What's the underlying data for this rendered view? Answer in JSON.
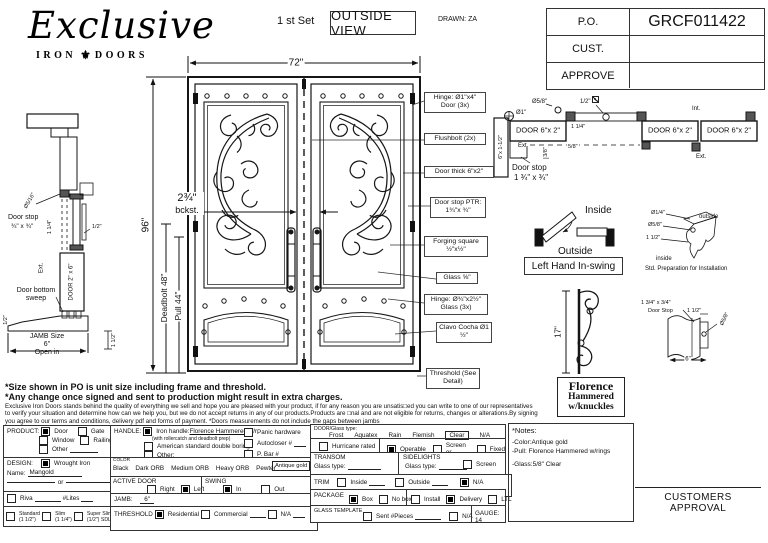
{
  "logo": {
    "script": "Exclusive",
    "left": "IRON",
    "mark": "⚜",
    "right": "DOORS"
  },
  "header": {
    "set": "1 st Set",
    "view": "OUTSIDE VIEW",
    "drawn": "DRAWN: ZA"
  },
  "po": {
    "r1l": "P.O.",
    "r1v": "GRCF011422",
    "r2l": "CUST.",
    "r2v": "",
    "r3l": "APPROVE",
    "r3v": ""
  },
  "door": {
    "w": "72\"",
    "h": "96\"",
    "deadbolt": "Deadbolt 48\"",
    "pull": "Pull 44\"",
    "backset1": "2¾\"",
    "backset2": "bckst."
  },
  "callouts": {
    "hinge_door": "Hinge: Ø1\"x4\" Door (3x)",
    "flushbolt": "Flushbolt (2x)",
    "door_thick": "Door thick 6\"x2\"",
    "door_stop": "Door stop PTR: 1¾\"x ¾\"",
    "forging": "Forging square ½\"x½\"",
    "glass": "Glass ⅝\"",
    "hinge_glass": "Hinge: Ø¾\"x2½\" Glass (3x)",
    "clavo": "Clavo Cocha Ø1 ½\"",
    "threshold": "Threshold (See Detail)"
  },
  "left_detail": {
    "dia": "Ø5/16\"",
    "stop1": "Door stop",
    "stop2": "¾\" x ¾\"",
    "dim114": "1 1/4\"",
    "dim12": "1/2\"",
    "ext": "Ext.",
    "door": "DOOR 2\" x 6\"",
    "sweep": "Door bottom sweep",
    "jamb1": "JAMB Size",
    "jamb2": "6\"",
    "open": "Open in",
    "dim112": "1 1/2\"",
    "dim12b": "1/2\""
  },
  "top_detail": {
    "dia1": "Ø1\"",
    "dia58": "Ø5/8\"",
    "dim12": "1/2\"",
    "jamb": "6\"x 1-1/2\"",
    "door1": "DOOR 6\"x 2\"",
    "door2": "DOOR 6\"x 2\"",
    "door3": "DOOR 6\"x 2\"",
    "ext1": "Ext.",
    "dim38": "3/8\"",
    "dim114": "1 1/4\"",
    "dim58": "5/8\"",
    "stop1": "Door stop",
    "stop2": "1 ¾\" x ¾\"",
    "int1": "Int.",
    "ext2": "Ext."
  },
  "swing": {
    "inside": "Inside",
    "outside": "Outside",
    "label": "Left Hand In-swing"
  },
  "prep": {
    "d14": "Ø1/4\"",
    "d58": "Ø5/8\"",
    "d112": "1 1/2\"",
    "outside": "outside",
    "inside": "inside",
    "caption": "Std. Preparation for Installation"
  },
  "pull_detail": {
    "dim": "17\"",
    "name1": "Florence",
    "name2": "Hammered",
    "name3": "w/knuckles"
  },
  "profile": {
    "stop1": "1 3/4\" x 3/4\"",
    "stop2": "Door Stop",
    "d112": "1 1/2\"",
    "d58": "Ø5/8\"",
    "d6": "6\""
  },
  "disclaimer": {
    "b1": "*Size shown in PO is unit size including frame and threshold.",
    "b2": "*Any change once signed and sent to production might result in extra charges.",
    "p": "Exclusive Iron Doors stands behind the quality of everything we sell and hope you are pleased with your product, if for any reason you are unsatis□ed you can write to one of our representatives to verify your situation and determine how can we help you, but we do not accept returns in any of our products.Products are □nal and are not eligible for returns, changes or alterations.By signing you agree to our terms and conditions, delivery pdf and forms of payment. *Doors measurements do not include the gaps between jambs"
  },
  "form": {
    "product": {
      "title": "PRODUCT:",
      "door": "Door",
      "door_on": true,
      "gate": "Gate",
      "gate_on": false,
      "window": "Window",
      "window_on": false,
      "railing": "Railing",
      "railing_on": false,
      "other": "Other",
      "other_on": false
    },
    "design": {
      "title": "DESIGN:",
      "wrought": "Wrought Iron",
      "wrought_on": true,
      "name_label": "Name:",
      "name_value": "Mangold",
      "or_label": "or",
      "riva": "Riva",
      "riva_on": false,
      "lites": "#Lites"
    },
    "thickness": {
      "standard": "Standard",
      "standard_sub": "(1 1/2\")",
      "standard_on": false,
      "slim": "Slim",
      "slim_sub": "(1 1/4\")",
      "slim_on": false,
      "super": "Super Slim",
      "super_sub": "(1/2\") SDL",
      "super_on": false
    },
    "handle": {
      "title": "HANDLE:",
      "iron_pre": "Iron handle:",
      "iron_name": "Florence Hammered",
      "iron_post": "w/r",
      "iron_on": true,
      "iron_sub": "(with rollercatch and deadbolt prep)",
      "american": "American standard double boring",
      "american_on": false,
      "other": "Other:",
      "other_on": false,
      "panic": "Panic hardware",
      "panic_on": false,
      "autocloser": "Autocloser #",
      "autocloser_on": false,
      "pbar": "P. Bar #",
      "pbar_on": false
    },
    "color": {
      "title": "COLOR",
      "o1": "Black",
      "o2": "Dark ORB",
      "o3": "Medium ORB",
      "o4": "Heavy ORB",
      "o5": "Pewter",
      "selected": "Antique gold"
    },
    "active": {
      "title": "ACTIVE DOOR",
      "right": "Right",
      "right_on": false,
      "left": "Left",
      "left_on": true
    },
    "swing": {
      "title": "SWING",
      "in": "In",
      "in_on": true,
      "out": "Out",
      "out_on": false
    },
    "jamb": {
      "title": "JAMB:",
      "value": "6\""
    },
    "threshold": {
      "title": "THRESHOLD",
      "res": "Residential",
      "res_on": true,
      "com": "Commercial",
      "com_on": false,
      "na": "N/A",
      "na_on": false
    },
    "glass": {
      "title": "DOOR/Glass type:",
      "o1": "Frost",
      "o2": "Aquatex",
      "o3": "Rain",
      "o4": "Flemish",
      "sel": "Clear",
      "o6": "N/A"
    },
    "row2": {
      "hurricane": "Hurricane rated",
      "hurricane_on": false,
      "operable": "Operable",
      "operable_on": true,
      "screen": "Screen or",
      "screen_on": false,
      "fixed": "Fixed",
      "fixed_on": false
    },
    "transom": {
      "title": "TRANSOM",
      "glass": "Glass type:"
    },
    "sidelights": {
      "title": "SIDELIGHTS",
      "glass": "Glass type:",
      "screen": "Screen",
      "screen_on": false
    },
    "trim": {
      "title": "TRIM",
      "inside": "Inside",
      "inside_on": false,
      "outside": "Outside",
      "outside_on": false,
      "na": "N/A",
      "na_on": true
    },
    "package": {
      "title": "PACKAGE",
      "box": "Box",
      "box_on": true,
      "nobox": "No box",
      "nobox_on": false,
      "install": "Install",
      "install_on": false,
      "delivery": "Delivery",
      "delivery_on": true,
      "ltl": "LTL",
      "ltl_on": false
    },
    "gtemplate": {
      "title": "GLASS TEMPLATE",
      "sent": "Sent #Pieces",
      "sent_on": false,
      "na": "N/A",
      "na_on": false,
      "gauge": "GAUGE: 14"
    }
  },
  "notes": {
    "title": "*Notes:",
    "i1": "-Color:Antique gold",
    "i2": "-Pull: Florence Hammered w/rings",
    "i3": "-Glass:5/8\" Clear"
  },
  "approval": "CUSTOMERS APPROVAL"
}
